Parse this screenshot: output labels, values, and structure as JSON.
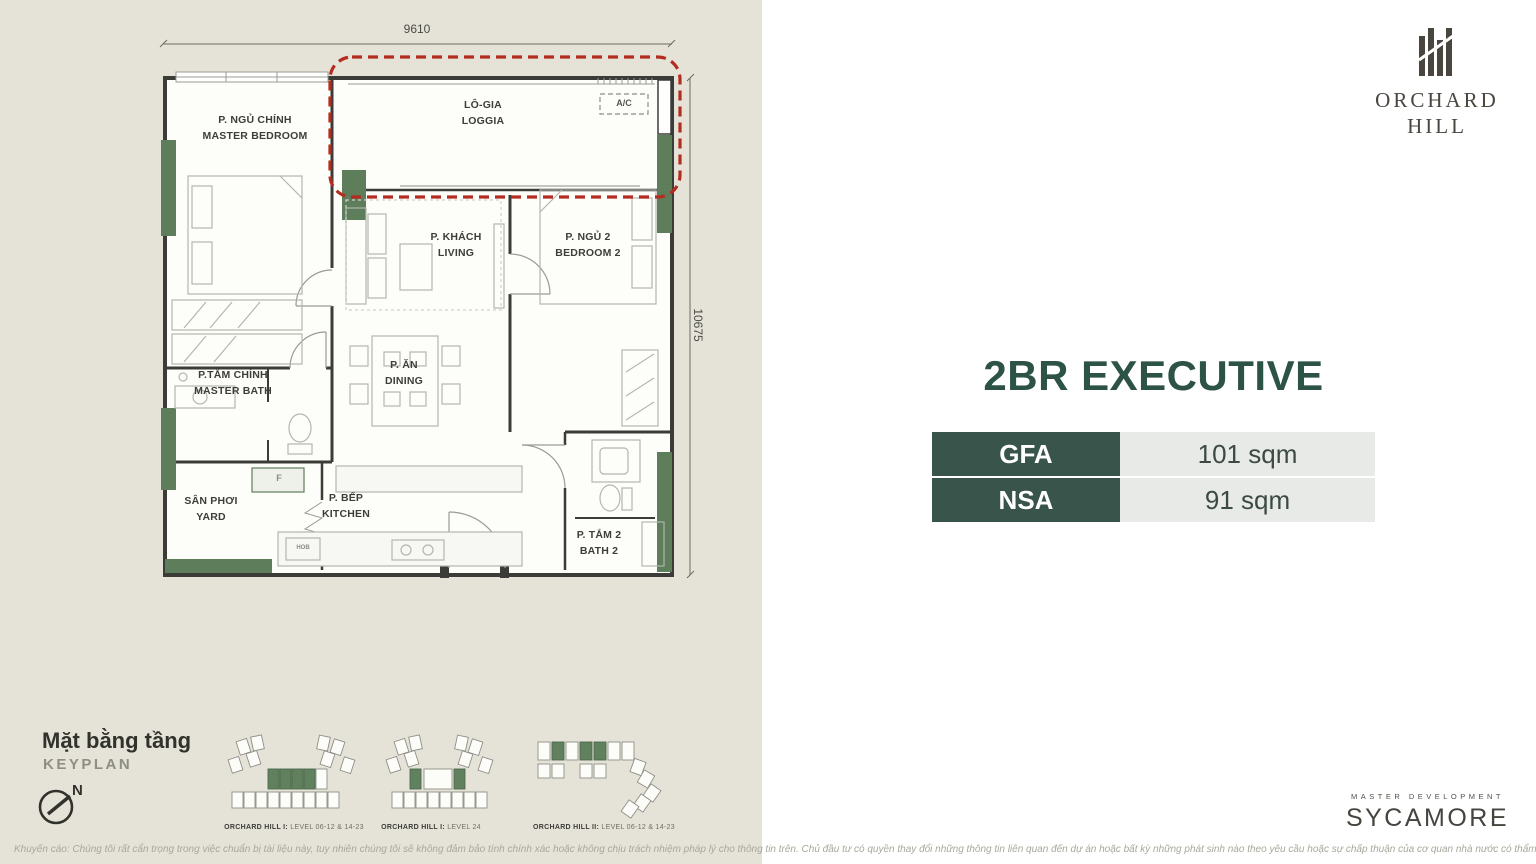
{
  "plan": {
    "dim_width": "9610",
    "dim_height": "10675",
    "rooms": {
      "master_bedroom": {
        "vi": "P. NGỦ CHÍNH",
        "en": "MASTER BEDROOM"
      },
      "loggia": {
        "vi": "LÔ-GIA",
        "en": "LOGGIA"
      },
      "living": {
        "vi": "P. KHÁCH",
        "en": "LIVING"
      },
      "bedroom2": {
        "vi": "P. NGỦ 2",
        "en": "BEDROOM 2"
      },
      "master_bath": {
        "vi": "P.TẮM CHÍNH",
        "en": "MASTER BATH"
      },
      "dining": {
        "vi": "P. ĂN",
        "en": "DINING"
      },
      "yard": {
        "vi": "SÂN PHƠI",
        "en": "YARD"
      },
      "kitchen": {
        "vi": "P. BẾP",
        "en": "KITCHEN"
      },
      "bath2": {
        "vi": "P. TẮM 2",
        "en": "BATH 2"
      }
    },
    "labels": {
      "ac": "A/C",
      "fridge": "F",
      "hob": "HOB"
    }
  },
  "keyplan": {
    "title_vi": "Mặt bằng tầng",
    "title_en": "KEYPLAN",
    "north": "N",
    "items": [
      {
        "name": "ORCHARD HILL I:",
        "levels": " LEVEL 06-12 & 14-23"
      },
      {
        "name": "ORCHARD HILL I:",
        "levels": " LEVEL 24"
      },
      {
        "name": "ORCHARD HILL II:",
        "levels": " LEVEL 06-12 & 14-23"
      }
    ]
  },
  "brand": {
    "line1": "ORCHARD",
    "line2": "HILL"
  },
  "unit": {
    "title": "2BR EXECUTIVE",
    "specs": [
      {
        "label": "GFA",
        "value": "101 sqm"
      },
      {
        "label": "NSA",
        "value": "91 sqm"
      }
    ]
  },
  "developer": {
    "tagline": "MASTER DEVELOPMENT",
    "name": "SYCAMORE"
  },
  "footer": {
    "disclaimer": "Khuyến cáo: Chúng tôi rất cẩn trọng trong việc chuẩn bị tài liệu này, tuy nhiên chúng tôi sẽ không đảm bảo tính chính xác hoặc không chịu trách nhiệm pháp lý cho thông tin trên. Chủ đầu tư có quyền thay đổi những thông tin liên quan đến dự án hoặc bất kỳ những phát sinh nào theo yêu cầu hoặc sự chấp thuận của cơ quan nhà nước có thẩm quyền."
  },
  "colors": {
    "panel_beige": "#e5e3d8",
    "accent_green": "#5e7d5b",
    "brand_green": "#2d5246",
    "table_green": "#39544a",
    "highlight_red": "#b42c20"
  }
}
